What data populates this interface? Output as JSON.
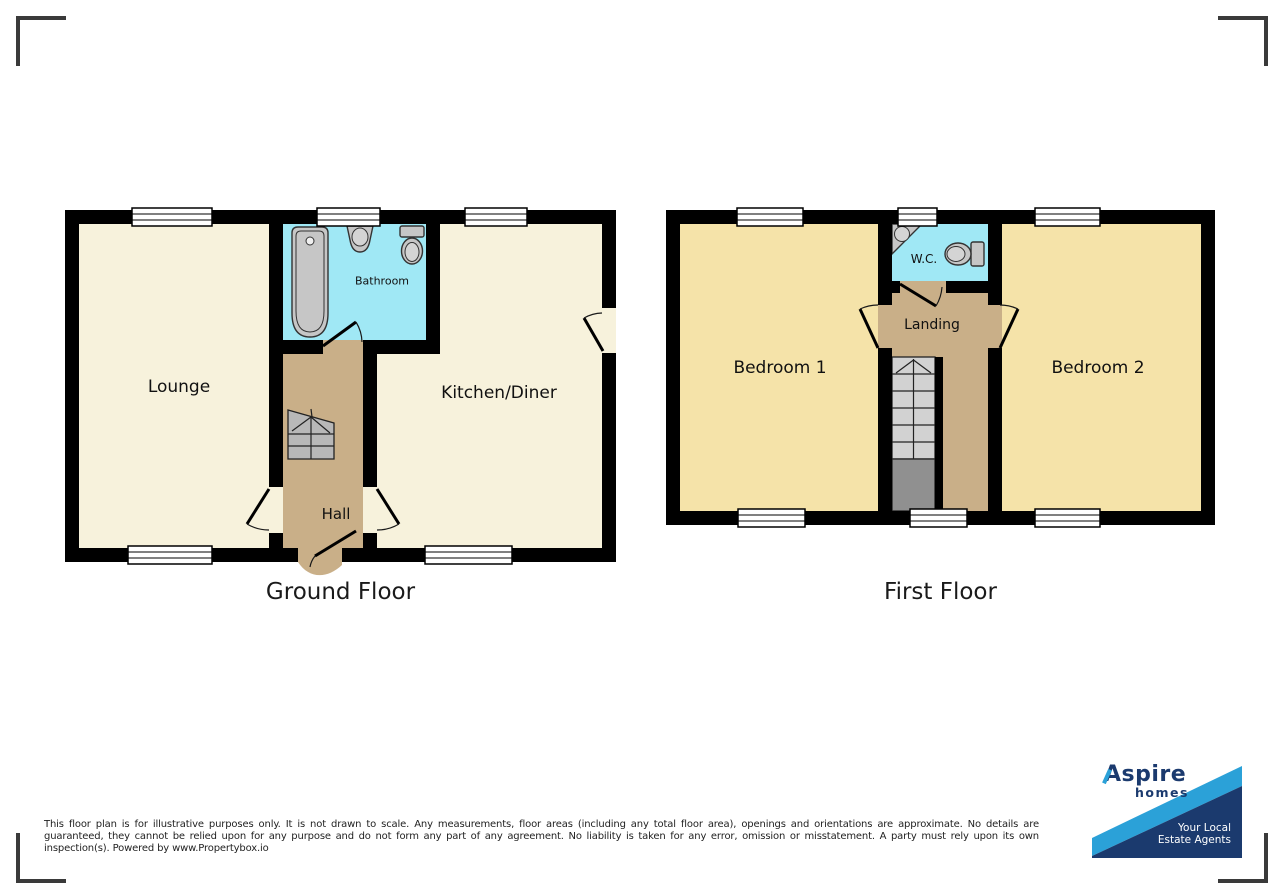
{
  "ground": {
    "title": "Ground Floor",
    "lounge": "Lounge",
    "bathroom": "Bathroom",
    "kitchen": "Kitchen/Diner",
    "hall": "Hall"
  },
  "first": {
    "title": "First Floor",
    "bedroom1": "Bedroom 1",
    "wc": "W.C.",
    "landing": "Landing",
    "bedroom2": "Bedroom 2"
  },
  "disclaimer": "This floor plan is for illustrative purposes only. It is not drawn to scale. Any measurements, floor areas (including any total floor area), openings and orientations are approximate. No details are guaranteed, they cannot be relied upon for any purpose and do not form any part of any agreement. No liability is taken for any error, omission or misstatement. A party must rely upon its own inspection(s). Powered by www.Propertybox.io",
  "logo": {
    "brand_initial": "A",
    "brand_rest": "spire",
    "brand_sub": "homes",
    "tagline1": "Your Local",
    "tagline2": "Estate Agents"
  },
  "colors": {
    "ground_room": "#f7f2dc",
    "bedroom": "#f5e3a9",
    "hall_landing": "#c9af88",
    "bathroom_wc": "#a0e8f5",
    "wall": "#000000",
    "logo_navy": "#1b3a6e",
    "logo_blue": "#2ba1d8"
  }
}
